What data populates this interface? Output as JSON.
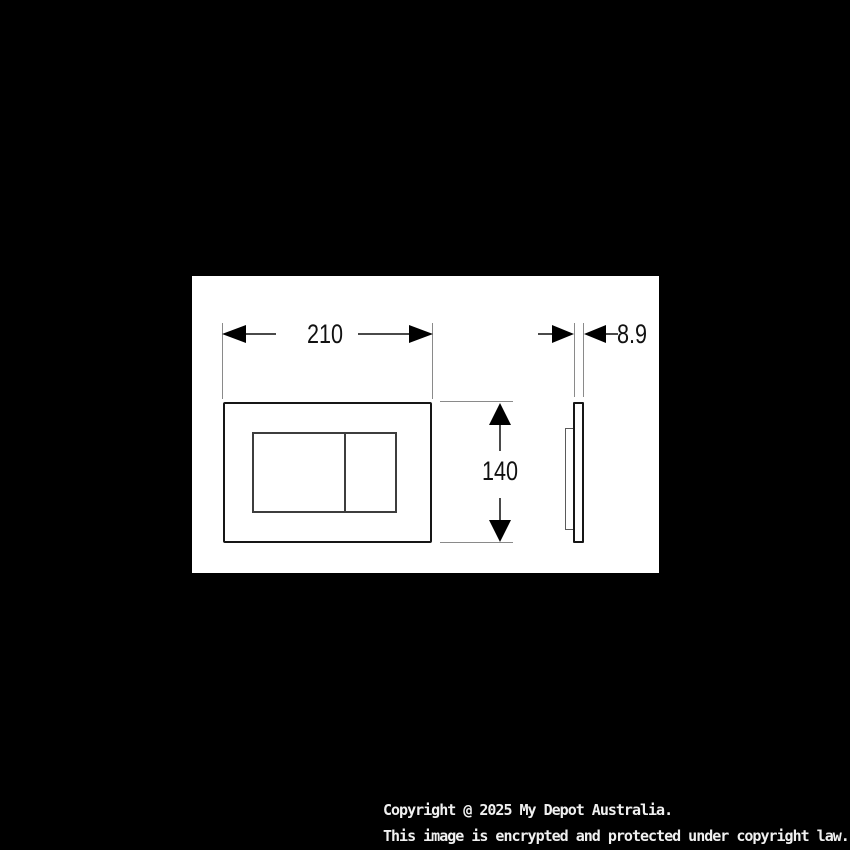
{
  "diagram": {
    "kind": "technical-dimension-drawing",
    "views": [
      "front",
      "side"
    ],
    "dims": {
      "width": "210",
      "height": "140",
      "depth": "8.9"
    }
  },
  "footer": {
    "line1": "Copyright @ 2025 My Depot Australia.",
    "line2": "This image is encrypted and protected under copyright law."
  },
  "colors": {
    "background": "#000000",
    "panel": "#ffffff",
    "plate_outline": "#161616",
    "button_outline": "#3d3d3d",
    "dimension_line": "#4a4a4a",
    "extension_line": "#8a8a8a",
    "arrow": "#000000",
    "dimension_text": "#111111",
    "footer_text": "#f0f0f0"
  }
}
